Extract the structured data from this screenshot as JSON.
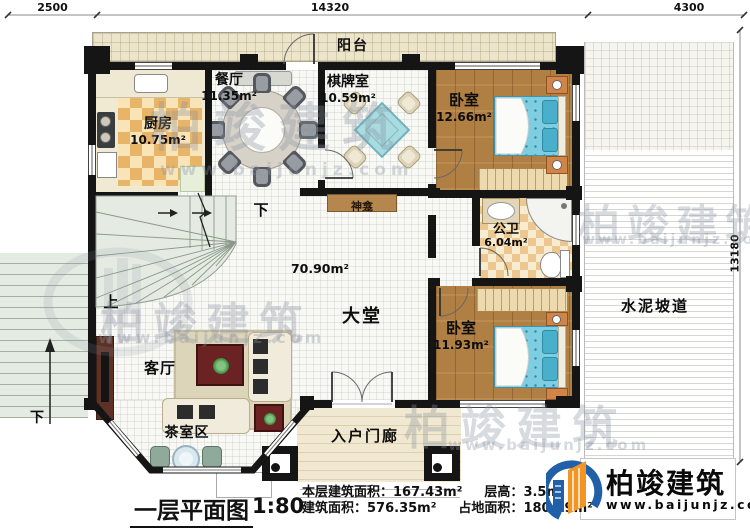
{
  "title": {
    "text": "一层平面图",
    "scale": "1:80"
  },
  "stats": {
    "floor_area_label": "本层建筑面积：",
    "floor_area_value": "167.43m²",
    "height_label": "层高：",
    "height_value": "3.5m",
    "total_area_label": "建筑面积：",
    "total_area_value": "576.35m²",
    "land_area_label": "占地面积：",
    "land_area_value": "180.79m²"
  },
  "dimensions": {
    "top_left": "2500",
    "top_middle": "14320",
    "top_right": "4300",
    "right": "13180"
  },
  "rooms": {
    "balcony": {
      "name": "阳台"
    },
    "kitchen": {
      "name": "厨房",
      "area": "10.75m²"
    },
    "dining": {
      "name": "餐厅",
      "area": "11.35m²"
    },
    "game_room": {
      "name": "棋牌室",
      "area": "10.59m²"
    },
    "bedroom_top": {
      "name": "卧室",
      "area": "12.66m²"
    },
    "bathroom": {
      "name": "公卫",
      "area": "6.04m²"
    },
    "bedroom_bottom": {
      "name": "卧室",
      "area": "11.93m²"
    },
    "hall": {
      "name": "大堂",
      "area": "70.90m²"
    },
    "living": {
      "name": "客厅"
    },
    "tea_area": {
      "name": "茶室区"
    },
    "entry_porch": {
      "name": "入户门廊"
    },
    "shrine": {
      "name": "神龛"
    },
    "ramp": {
      "name": "水泥坡道"
    }
  },
  "stairs": {
    "up": "上",
    "down": "下",
    "outdoor_down": "下"
  },
  "logo": {
    "name": "柏竣建筑",
    "url": "www.baijunjz.com"
  },
  "watermark": {
    "name": "柏竣建筑",
    "url": "www.baijunjz.com"
  },
  "colors": {
    "wall": "#151515",
    "wood_floor": "#b07f43",
    "bed": "#7fcde0",
    "kitchen_checker": "#e8b468",
    "stairs": "#e5ebe2",
    "shrine": "#b5874e",
    "logo_blue": "#2160a8",
    "logo_orange": "#f49523"
  }
}
